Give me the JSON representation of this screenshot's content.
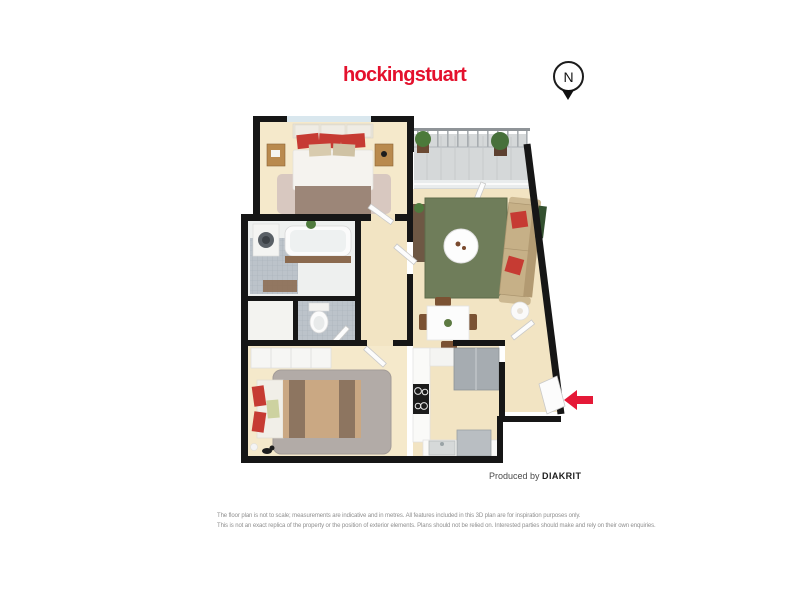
{
  "page": {
    "background_color": "#ffffff"
  },
  "colors": {
    "brand": "#e4112d",
    "arrow": "#e51937",
    "wall": "#161616",
    "beige": "#f2e4c3",
    "beige2": "#f5e9cb",
    "tile": "#bcc3ca",
    "balconytile": "#d5d8d9",
    "ruggreen": "#6f7d5a",
    "ruggray": "#b2aba7",
    "carpet": "#d8c8c0",
    "red": "#c63b33",
    "wood": "#b98a4e",
    "sofa": "#c6b087"
  },
  "header": {
    "logo_text": "hockingstuart"
  },
  "compass": {
    "letter": "N"
  },
  "credit": {
    "prefix": "Produced by ",
    "brand": "DIAKRIT"
  },
  "disclaimer": {
    "line1": "The floor plan is not to scale; measurements are indicative and in metres. All features included in this 3D plan are for inspiration purposes only.",
    "line2": "This is not an exact replica of the property or the position of exterior elements. Plans should not be relied on. Interested parties should make and rely on their own enquiries."
  },
  "floorplan": {
    "kind": "3d-top-view-floor-plan",
    "entry_arrow_direction": "left",
    "rooms": [
      {
        "name": "bedroom-1",
        "position": "top-left",
        "features": [
          "double-bed",
          "red-cushions",
          "two-bedside-tables",
          "rug",
          "wall-art",
          "window"
        ]
      },
      {
        "name": "balcony",
        "position": "top-right",
        "features": [
          "railing",
          "two-potted-plants",
          "tiled-floor",
          "sliding-glass-door"
        ]
      },
      {
        "name": "living-room",
        "position": "right",
        "features": [
          "sofa-with-red-cushions",
          "green-rug",
          "round-coffee-table",
          "side-table",
          "console",
          "wall-art"
        ]
      },
      {
        "name": "dining-area",
        "position": "center-right",
        "features": [
          "dining-table",
          "four-chairs",
          "centerpiece-plant"
        ]
      },
      {
        "name": "bathroom",
        "position": "middle-left",
        "features": [
          "bathtub",
          "washing-machine",
          "plant",
          "bath-mat",
          "mosaic-tiles",
          "window"
        ]
      },
      {
        "name": "wc",
        "position": "center",
        "features": [
          "toilet",
          "mosaic-tiles"
        ]
      },
      {
        "name": "hallway",
        "position": "center",
        "features": [
          "doors"
        ]
      },
      {
        "name": "bedroom-2",
        "position": "bottom-left",
        "features": [
          "double-bed-striped-quilt",
          "red-cushions",
          "shaggy-grey-rug",
          "wardrobe",
          "windows",
          "cat-figure"
        ]
      },
      {
        "name": "kitchen",
        "position": "bottom-center",
        "features": [
          "cooktop",
          "fridge",
          "sink",
          "counters",
          "appliance"
        ]
      },
      {
        "name": "entry",
        "position": "bottom-right",
        "features": [
          "open-entry-door",
          "red-entry-arrow"
        ]
      }
    ]
  }
}
